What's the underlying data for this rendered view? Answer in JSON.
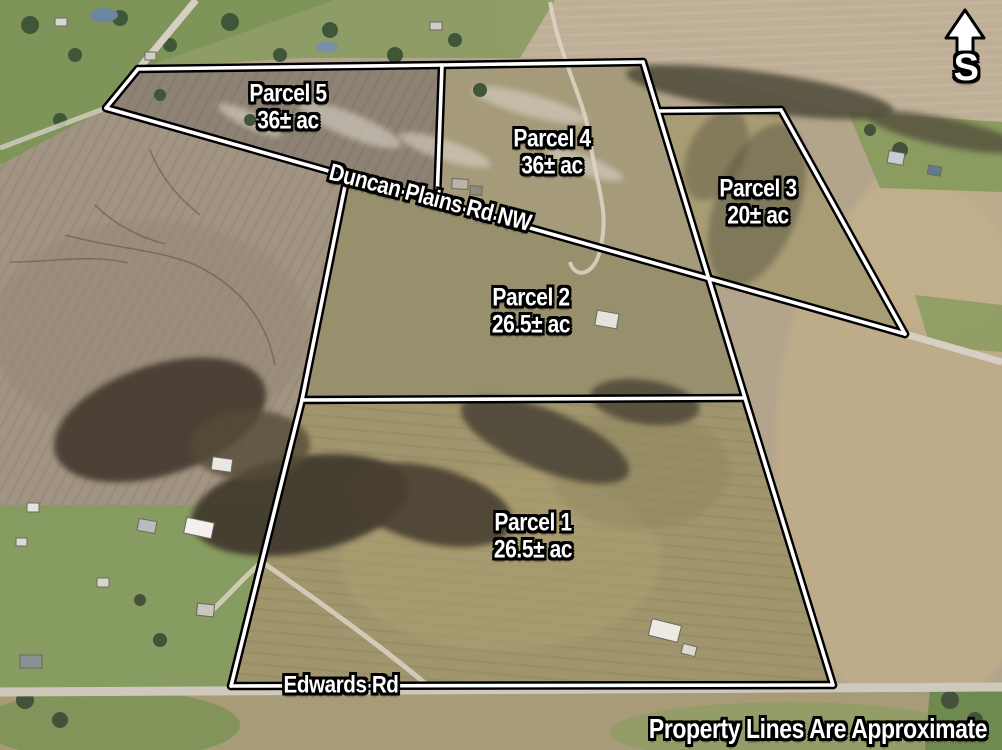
{
  "map": {
    "compass": {
      "letter": "S"
    },
    "parcels": [
      {
        "id": "parcel-5",
        "name": "Parcel 5",
        "acreage": "36± ac"
      },
      {
        "id": "parcel-4",
        "name": "Parcel 4",
        "acreage": "36± ac"
      },
      {
        "id": "parcel-3",
        "name": "Parcel 3",
        "acreage": "20± ac"
      },
      {
        "id": "parcel-2",
        "name": "Parcel 2",
        "acreage": "26.5± ac"
      },
      {
        "id": "parcel-1",
        "name": "Parcel 1",
        "acreage": "26.5± ac"
      }
    ],
    "roads": [
      {
        "id": "duncan-plains-rd",
        "label": "Duncan Plains Rd NW"
      },
      {
        "id": "edwards-rd",
        "label": "Edwards Rd"
      }
    ],
    "disclaimer": "Property Lines Are Approximate",
    "colors": {
      "boundary_line": "#ffffff",
      "boundary_outline": "#000000",
      "label_text": "#ffffff"
    }
  }
}
